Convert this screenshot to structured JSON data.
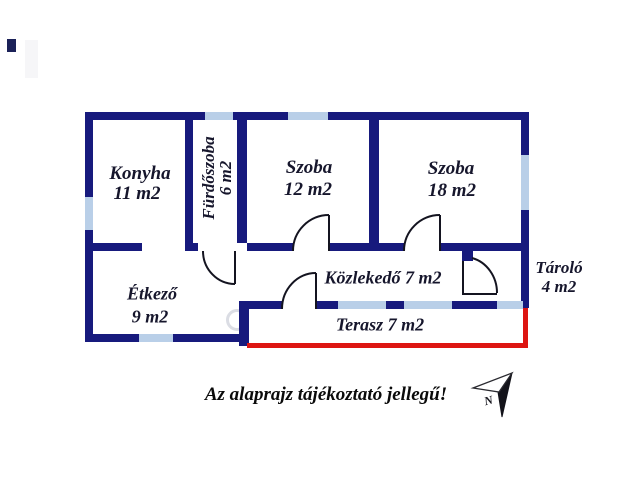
{
  "disclaimer": "Az alaprajz tájékoztató jellegű!",
  "colors": {
    "wall": "#171a7d",
    "window": "#b9cfe8",
    "terrace_line": "#dd1512",
    "room_text": "#16162c",
    "note_text": "#0a0a0a"
  },
  "rooms": [
    {
      "id": "konyha",
      "name": "Konyha",
      "area": "11 m2"
    },
    {
      "id": "furdoszoba",
      "name": "Fürdőszoba",
      "area": "6 m2"
    },
    {
      "id": "szoba-12",
      "name": "Szoba",
      "area": "12 m2"
    },
    {
      "id": "szoba-18",
      "name": "Szoba",
      "area": "18 m2"
    },
    {
      "id": "etkezo",
      "name": "Étkező",
      "area": "9 m2"
    },
    {
      "id": "kozlekedo",
      "name": "Közlekedő",
      "area": "7 m2",
      "inline_label": "Közlekedő 7 m2"
    },
    {
      "id": "tarolo",
      "name": "Tároló",
      "area": "4 m2"
    },
    {
      "id": "terasz",
      "name": "Terasz",
      "area": "7 m2",
      "inline_label": "Terasz 7 m2"
    }
  ],
  "compass": {
    "label": "N"
  }
}
